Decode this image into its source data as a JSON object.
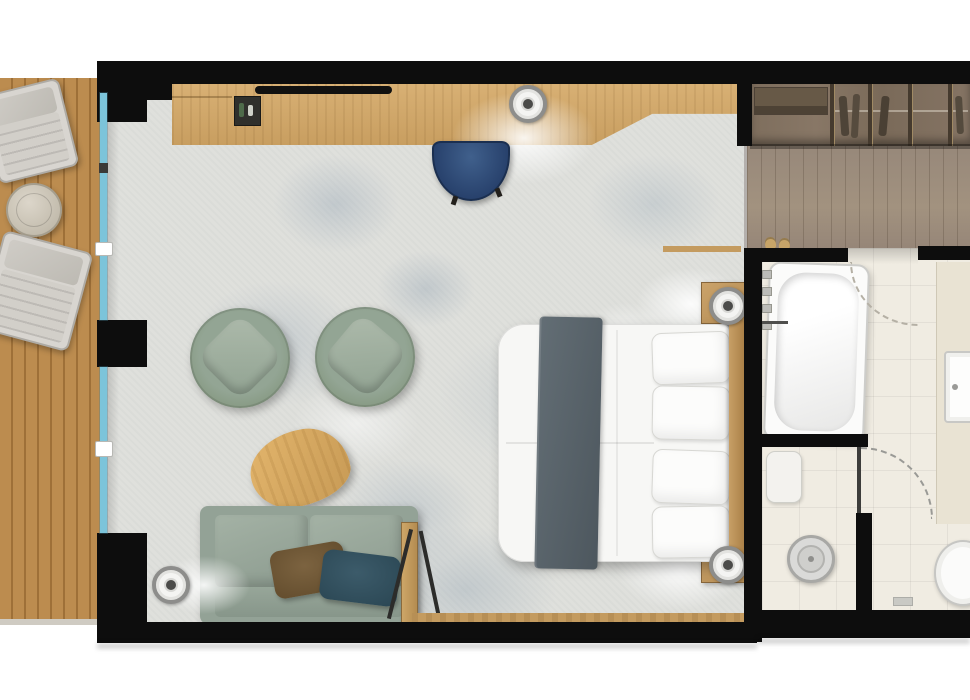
{
  "meta": {
    "type": "floor-plan",
    "view": "top-down architectural rendering",
    "title": "Hotel suite floor plan (no text labels rendered in image)"
  },
  "palette": {
    "wall": "#0d0d0d",
    "terrace_wood": "#b5854a",
    "room_floor": "#dfe0dc",
    "floor_mottle_blue": "#7a90a8",
    "corridor_wood": "#9c8c7b",
    "wardrobe_wood": "#7e6e5d",
    "bathroom_tile": "#f0ece2",
    "desk_wood": "#d0a768",
    "accent_wood": "#c49b5f",
    "glass": "#7cc4da",
    "sofa_fabric": "#93a296",
    "armchair_fabric": "#8b9e8e",
    "pillow_brown": "#6e5634",
    "pillow_teal": "#33515f",
    "desk_chair_navy": "#2c4a74",
    "bed_linen": "#f7f7f5",
    "bed_throw": "#57626a"
  },
  "rooms": [
    {
      "name": "terrace",
      "furniture": [
        "sun-lounger",
        "sun-lounger",
        "round-side-table"
      ],
      "features": [
        "wood-deck-planks",
        "sliding-glass-wall"
      ]
    },
    {
      "name": "bedroom-living",
      "furniture": [
        "desk-console",
        "tv",
        "minibar-tray",
        "desk-chair",
        "armchair",
        "armchair",
        "coffee-table",
        "sofa",
        "sofa-pillow-brown",
        "sofa-pillow-teal",
        "luggage-rack",
        "double-bed",
        "pillows-x4",
        "bed-throw",
        "nightstand",
        "nightstand"
      ],
      "features": [
        "recessed-spotlight-x4",
        "mottled-carpet-floor",
        "wood-trim"
      ]
    },
    {
      "name": "entry-corridor",
      "furniture": [
        "open-wardrobe-with-hangers",
        "slippers"
      ],
      "features": [
        "wood-plank-floor"
      ]
    },
    {
      "name": "bathroom",
      "furniture": [
        "bathtub",
        "shower-bench",
        "rain-shower-head",
        "toilet",
        "washbasin",
        "vanity-counter"
      ],
      "features": [
        "tile-floor",
        "door-swing-arc",
        "wall-hooks",
        "tub-faucet"
      ]
    }
  ]
}
